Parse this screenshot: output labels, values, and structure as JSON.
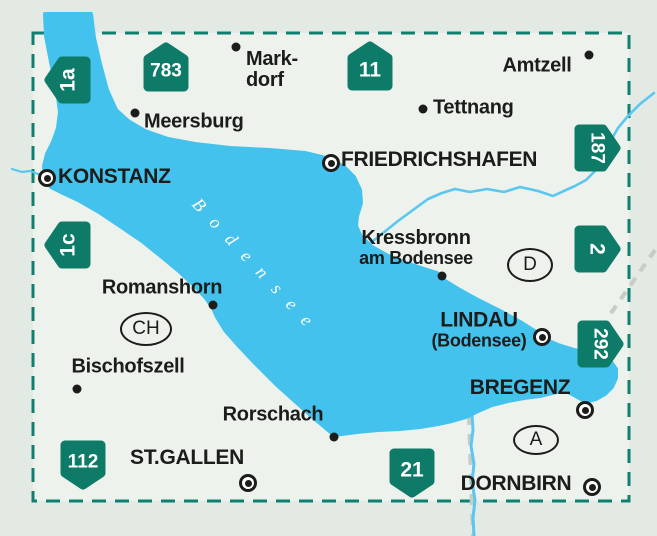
{
  "colors": {
    "bg": "#e3eae4",
    "map-bg": "#edf2ec",
    "lake": "#44c2ee",
    "river": "#5ac7f1",
    "badge": "#0e7b68",
    "border": "#0f8070",
    "gray": "#c6cdc6",
    "ink": "#1c1c1a"
  },
  "lake": {
    "name": "Bodensee"
  },
  "badges": [
    {
      "label": "1a",
      "orient": "left",
      "x": 42,
      "y": 53
    },
    {
      "label": "783",
      "orient": "up",
      "x": 140,
      "y": 40
    },
    {
      "label": "11",
      "orient": "up",
      "x": 344,
      "y": 39
    },
    {
      "label": "187",
      "orient": "right",
      "x": 571,
      "y": 121
    },
    {
      "label": "1c",
      "orient": "left",
      "x": 42,
      "y": 218
    },
    {
      "label": "2",
      "orient": "right",
      "x": 571,
      "y": 222
    },
    {
      "label": "292",
      "orient": "right",
      "x": 574,
      "y": 317
    },
    {
      "label": "112",
      "orient": "down",
      "x": 57,
      "y": 438
    },
    {
      "label": "21",
      "orient": "down",
      "x": 386,
      "y": 446
    }
  ],
  "places": [
    {
      "id": "konstanz",
      "kind": "city",
      "lines": [
        "KONSTANZ"
      ],
      "align": "left",
      "lx": 58,
      "ly": 177,
      "dot": {
        "x": 47,
        "y": 178
      }
    },
    {
      "id": "friedrichshafen",
      "kind": "city",
      "lines": [
        "FRIEDRICHSHAFEN"
      ],
      "align": "left",
      "lx": 341,
      "ly": 160,
      "dot": {
        "x": 331,
        "y": 163
      }
    },
    {
      "id": "lindau",
      "kind": "city",
      "lines": [
        "LINDAU",
        "(Bodensee)"
      ],
      "sub": [
        1
      ],
      "align": "center",
      "lx": 479,
      "ly": 330,
      "dot": {
        "x": 542,
        "y": 337
      }
    },
    {
      "id": "bregenz",
      "kind": "city",
      "lines": [
        "BREGENZ"
      ],
      "align": "center",
      "lx": 520,
      "ly": 388,
      "dot": {
        "x": 585,
        "y": 410
      }
    },
    {
      "id": "st-gallen",
      "kind": "city",
      "lines": [
        "ST.GALLEN"
      ],
      "align": "center",
      "lx": 187,
      "ly": 458,
      "dot": {
        "x": 248,
        "y": 483
      }
    },
    {
      "id": "dornbirn",
      "kind": "city",
      "lines": [
        "DORNBIRN"
      ],
      "align": "center",
      "lx": 516,
      "ly": 484,
      "dot": {
        "x": 592,
        "y": 487
      }
    },
    {
      "id": "markdorf",
      "kind": "town",
      "lines": [
        "Mark-",
        "dorf"
      ],
      "align": "left",
      "lx": 246,
      "ly": 70,
      "dot": {
        "x": 236,
        "y": 47
      }
    },
    {
      "id": "meersburg",
      "kind": "town",
      "lines": [
        "Meersburg"
      ],
      "align": "left",
      "lx": 144,
      "ly": 122,
      "dot": {
        "x": 135,
        "y": 113
      }
    },
    {
      "id": "tettnang",
      "kind": "town",
      "lines": [
        "Tettnang"
      ],
      "align": "left",
      "lx": 433,
      "ly": 108,
      "dot": {
        "x": 423,
        "y": 109
      }
    },
    {
      "id": "amtzell",
      "kind": "town",
      "lines": [
        "Amtzell"
      ],
      "align": "center",
      "lx": 537,
      "ly": 66,
      "dot": {
        "x": 589,
        "y": 55
      }
    },
    {
      "id": "kressbronn",
      "kind": "town",
      "lines": [
        "Kressbronn",
        "am Bodensee"
      ],
      "sub": [
        1
      ],
      "align": "center",
      "lx": 416,
      "ly": 248,
      "dot": {
        "x": 442,
        "y": 276
      }
    },
    {
      "id": "romanshorn",
      "kind": "town",
      "lines": [
        "Romanshorn"
      ],
      "align": "center",
      "lx": 162,
      "ly": 288,
      "dot": {
        "x": 213,
        "y": 305
      }
    },
    {
      "id": "bischofszell",
      "kind": "town",
      "lines": [
        "Bischofszell"
      ],
      "align": "center",
      "lx": 128,
      "ly": 367,
      "dot": {
        "x": 77,
        "y": 389
      }
    },
    {
      "id": "rorschach",
      "kind": "town",
      "lines": [
        "Rorschach"
      ],
      "align": "center",
      "lx": 273,
      "ly": 415,
      "dot": {
        "x": 334,
        "y": 437
      }
    }
  ],
  "country_marks": [
    {
      "label": "CH",
      "cx": 144,
      "cy": 327,
      "rx": 24,
      "ry": 15
    },
    {
      "label": "D",
      "cx": 528,
      "cy": 263,
      "rx": 21,
      "ry": 15
    },
    {
      "label": "A",
      "cx": 534,
      "cy": 438,
      "rx": 21,
      "ry": 13
    }
  ]
}
